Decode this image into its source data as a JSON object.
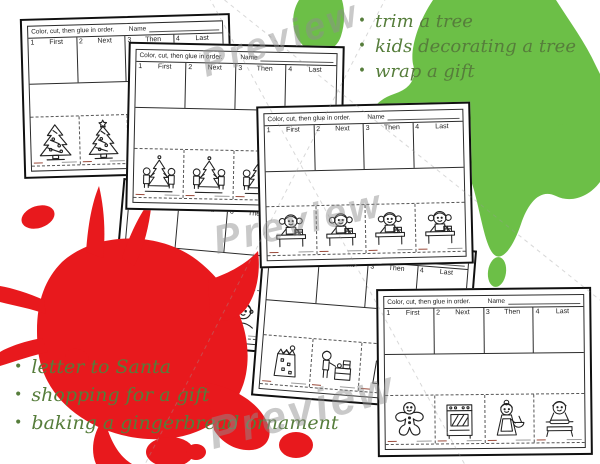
{
  "watermark": {
    "text": "Preview"
  },
  "lists": {
    "bullet": "•",
    "top_items": [
      "trim a tree",
      "kids decorating a tree",
      "wrap a gift"
    ],
    "bottom_items": [
      "letter to Santa",
      "shopping for a gift",
      "baking a gingerbread ornament"
    ]
  },
  "worksheet": {
    "instructions": "Color, cut, then glue in order.",
    "name_label": "Name",
    "cells": [
      {
        "num": "1",
        "label": "First"
      },
      {
        "num": "2",
        "label": "Next"
      },
      {
        "num": "3",
        "label": "Then"
      },
      {
        "num": "4",
        "label": "Last"
      }
    ]
  },
  "sheets": [
    {
      "name": "trim-a-tree",
      "images": [
        "christmas-tree",
        "christmas-tree-with-star",
        "christmas-tree",
        "christmas-tree-with-star"
      ]
    },
    {
      "name": "kids-decorating-a-tree",
      "images": [
        "kids-decorating-tree",
        "kids-decorating-tree",
        "kids-decorating-tree",
        "kids-decorating-tree"
      ]
    },
    {
      "name": "wrap-a-gift",
      "images": [
        "girl-wrapping-gift",
        "girl-wrapping-gift",
        "girl-wrapping-gift",
        "girl-wrapping-gift"
      ]
    },
    {
      "name": "letter-to-santa",
      "images": [
        "mailbox",
        "writing-desk",
        "child-head",
        "child-head"
      ]
    },
    {
      "name": "shopping-for-a-gift",
      "images": [
        "gift-bag",
        "shopper-at-counter",
        "gift-bag",
        "shopper-at-counter"
      ]
    },
    {
      "name": "baking-a-gingerbread",
      "images": [
        "gingerbread-man",
        "oven",
        "woman-with-mixing-bowl",
        "boy-rolling-dough"
      ]
    }
  ],
  "colors": {
    "red_splat": "#e8191d",
    "green_splat": "#6cbf47",
    "script_text": "#567d3b",
    "watermark_gray": "#8f8f8f"
  }
}
